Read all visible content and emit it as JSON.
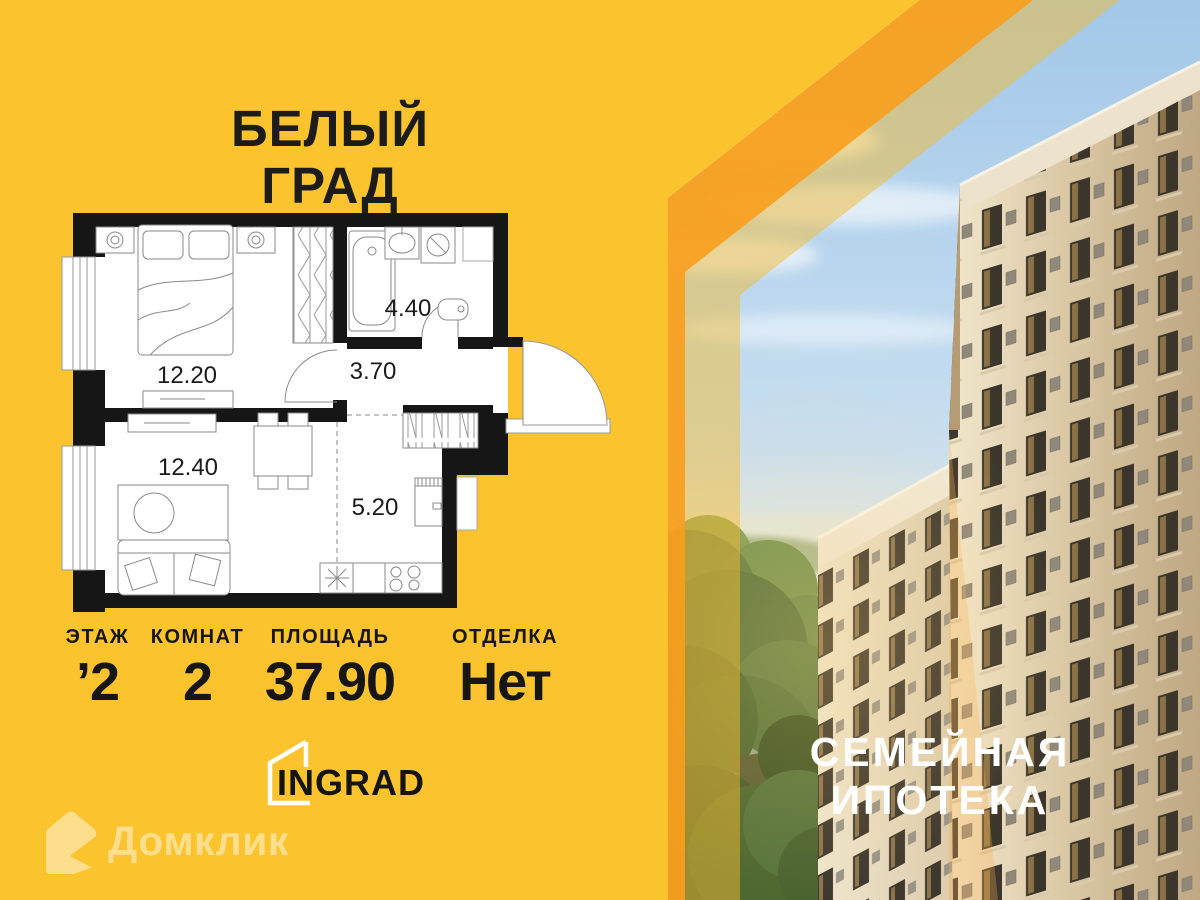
{
  "colors": {
    "background": "#FBC42E",
    "stripe_orange": "#F8A01F",
    "wall_black": "#161616",
    "promo_text": "#FFFFFF"
  },
  "header": {
    "complex_name_line1": "БЕЛЫЙ",
    "complex_name_line2": "ГРАД"
  },
  "floor_plan": {
    "rooms": [
      {
        "name": "bedroom",
        "area": "12.20"
      },
      {
        "name": "living-room",
        "area": "12.40"
      },
      {
        "name": "hallway",
        "area": "3.70"
      },
      {
        "name": "bathroom",
        "area": "4.40"
      },
      {
        "name": "kitchen",
        "area": "5.20"
      }
    ]
  },
  "stats": {
    "floor": {
      "label": "ЭТАЖ",
      "value": "’2"
    },
    "rooms": {
      "label": "КОМНАТ",
      "value": "2"
    },
    "area": {
      "label": "ПЛОЩАДЬ",
      "value": "37.90"
    },
    "finish": {
      "label": "ОТДЕЛКА",
      "value": "Нет"
    }
  },
  "developer": {
    "name": "INGRAD"
  },
  "watermark": {
    "name": "Домклик"
  },
  "promo": {
    "line1": "СЕМЕЙНАЯ",
    "line2": "ИПОТЕКА"
  }
}
